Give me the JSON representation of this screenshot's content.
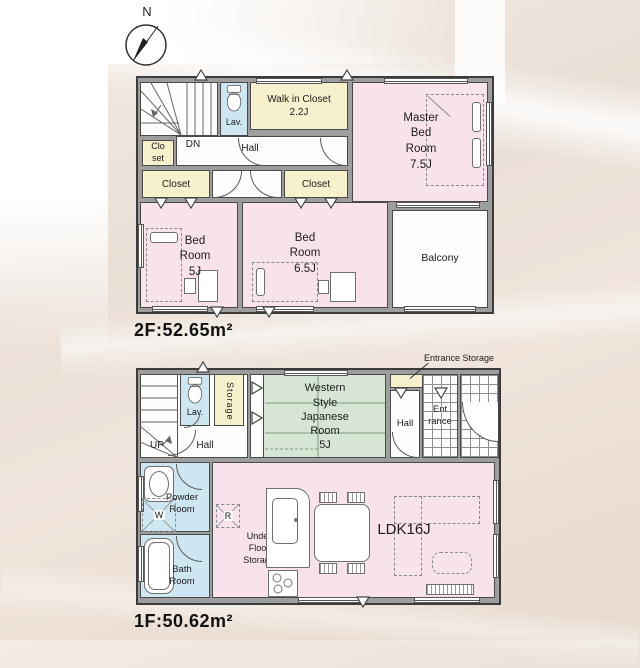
{
  "compass": {
    "label": "N"
  },
  "floor2": {
    "area_label": "2F:52.65m²",
    "rooms": {
      "stairs_dn": "DN",
      "lav": "Lav.",
      "walk_in_closet": "Walk in Closet\n2.2J",
      "closet_small": "Clo\nset",
      "hall": "Hall",
      "closet_left": "Closet",
      "closet_right": "Closet",
      "master_bedroom": "Master\nBed\nRoom\n7.5J",
      "bedroom_5j": "Bed\nRoom\n5J",
      "bedroom_65j": "Bed\nRoom\n6.5J",
      "balcony": "Balcony"
    }
  },
  "floor1": {
    "area_label": "1F:50.62m²",
    "rooms": {
      "stairs_up": "UP",
      "hall_stairs": "Hall",
      "lav": "Lav.",
      "storage": "Storage",
      "japanese_room": "Western\nStyle\nJapanese\nRoom\n5J",
      "entrance_storage": "Entrance Storage",
      "hall_entrance": "Hall",
      "entrance": "Ent\nrance",
      "powder_room": "Powder\nRoom",
      "washer": "W",
      "bath_room": "Bath\nRoom",
      "refrigerator": "R",
      "under_floor_storage": "Under\nFloor\nStorage",
      "ldk": "LDK16J"
    }
  },
  "palette": {
    "room_pink": "#f8e3ec",
    "closet_cream": "#f6f0cc",
    "wet_area_blue": "#cde6f2",
    "tatami_green": "#d6e5d4",
    "wall_gray": "#9d9d9d",
    "wall_outline": "#3c3c3c",
    "background_beige": "#eadfd6",
    "tile_white": "#fcfcfc"
  }
}
